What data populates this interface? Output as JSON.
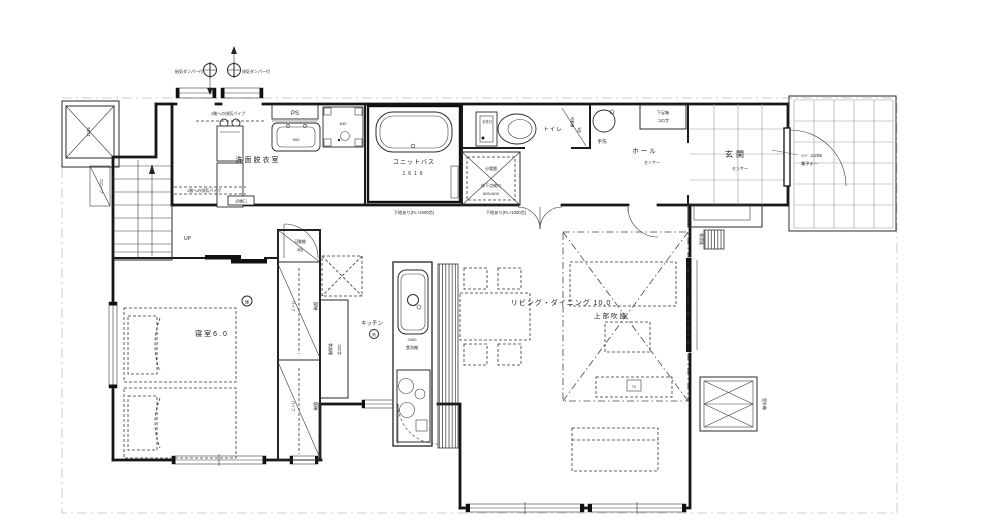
{
  "rooms": {
    "laundry": "洗面脱衣室",
    "bath": "ユニットバス",
    "bath_size": "1616",
    "toilet": "トイレ",
    "hall": "ホール",
    "hall_note": "センサー",
    "entrance": "玄関",
    "entrance_note": "センサー",
    "bedroom": "寝室6.0",
    "kitchen": "キッチン",
    "living_dining": "リビング・ダイニング 10.0",
    "void_above": "上部吹抜"
  },
  "fixtures": {
    "pipe_space": "PS",
    "vanity_width": "900",
    "washer_pan": "640",
    "toilet_tank": "手洗付",
    "toilet_shelf": "可動棚",
    "toilet_shelf_count": "3段",
    "dist_board": "分電盤",
    "floor_hatch": "床下点検口",
    "floor_hatch_size": "600×600",
    "shoe_box": "下足箱",
    "shoe_box_shape": "コの字",
    "hand_wash": "手洗",
    "cupboard": "食器棚",
    "cupboard_shape": "コの字",
    "dishwasher_width": "2400",
    "dishwasher": "食洗機",
    "closet_shelf": "可動棚",
    "closet_shelf_count": "3段",
    "storage1": "収納",
    "storage2": "収納",
    "hanger_pipe1": "パイプ",
    "hanger_pipe2": "パイプ",
    "tv": "TV"
  },
  "equipment": {
    "vent_top_note": "2階への排気パイプ",
    "vent_bottom_note": "1階への排気パイプ",
    "vent_access": "点検口",
    "damper_supply": "給気ダンパー付",
    "damper_exhaust": "排気ダンパー付",
    "water_heater": "給湯器",
    "outdoor_unit": "室外機",
    "detector_bedroom": "煙",
    "detector_kitchen": "熱"
  },
  "doors": {
    "entrance_model": "ｲﾉﾍﾞ 21050",
    "entrance_key": "電子キー"
  },
  "notes": {
    "base_note1": "下地あり(FL+1000芯)",
    "base_note2": "下地あり(FL+1000芯)",
    "stair_up": "UP",
    "shaft_dim": "1105",
    "slope": "スロープ"
  }
}
